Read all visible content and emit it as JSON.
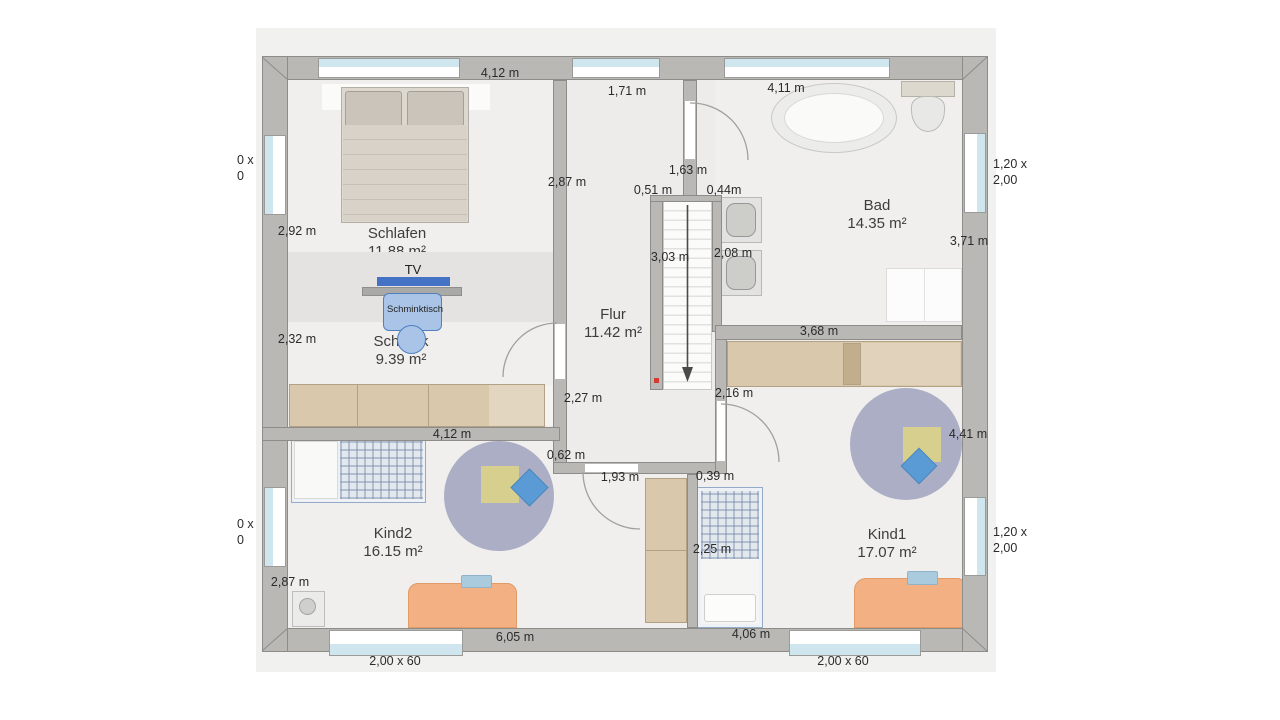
{
  "plan": {
    "rooms": [
      {
        "name": "Schlafen",
        "area": "11.88 m²"
      },
      {
        "name": "Schrank",
        "area": "9.39 m²"
      },
      {
        "name": "Flur",
        "area": "11.42 m²"
      },
      {
        "name": "Bad",
        "area": "14.35 m²"
      },
      {
        "name": "Kind2",
        "area": "16.15 m²"
      },
      {
        "name": "Kind1",
        "area": "17.07 m²"
      }
    ],
    "furniture_labels": {
      "tv": "TV",
      "schminktisch": "Schminktisch"
    },
    "dimensions": [
      {
        "text": "4,12 m"
      },
      {
        "text": "1,71 m"
      },
      {
        "text": "4,11 m"
      },
      {
        "text": "2,87 m"
      },
      {
        "text": "1,63 m"
      },
      {
        "text": "0,51 m"
      },
      {
        "text": "0,44m"
      },
      {
        "text": "2,92 m"
      },
      {
        "text": "3,03 m"
      },
      {
        "text": "2,08 m"
      },
      {
        "text": "3,71 m"
      },
      {
        "text": "2,32 m"
      },
      {
        "text": "3,68 m"
      },
      {
        "text": "2,16 m"
      },
      {
        "text": "2,27 m"
      },
      {
        "text": "4,12 m"
      },
      {
        "text": "0,62 m"
      },
      {
        "text": "1,93 m"
      },
      {
        "text": "0,39 m"
      },
      {
        "text": "4,41 m"
      },
      {
        "text": "2,25 m"
      },
      {
        "text": "2,87 m"
      },
      {
        "text": "6,05 m"
      },
      {
        "text": "4,06 m"
      }
    ],
    "window_labels": {
      "bottom_left": "2,00 x 60",
      "bottom_right": "2,00 x 60",
      "right_top": {
        "line1": "1,20 x",
        "line2": "2,00"
      },
      "right_bottom": {
        "line1": "1,20 x",
        "line2": "2,00"
      },
      "left_top": {
        "line1": "0 x",
        "line2": "0"
      },
      "left_bottom": {
        "line1": "0 x",
        "line2": "0"
      }
    },
    "colors": {
      "wall": "#b9b8b5",
      "floor": "#f0efed",
      "window_glass": "#cfe6ef",
      "tv_blue": "#4472c4",
      "furniture_blue": "#a9c4e6",
      "wardrobe_tan": "#d9c8ac",
      "rug": "#abaec5",
      "desk_orange": "#f3b183",
      "pillow_diamond_blue": "#5b9bd5",
      "play_mat_yellow": "#d7cf8d",
      "stair_arrow": "#4a4a4a",
      "start_dot_red": "#d23b2f"
    }
  }
}
